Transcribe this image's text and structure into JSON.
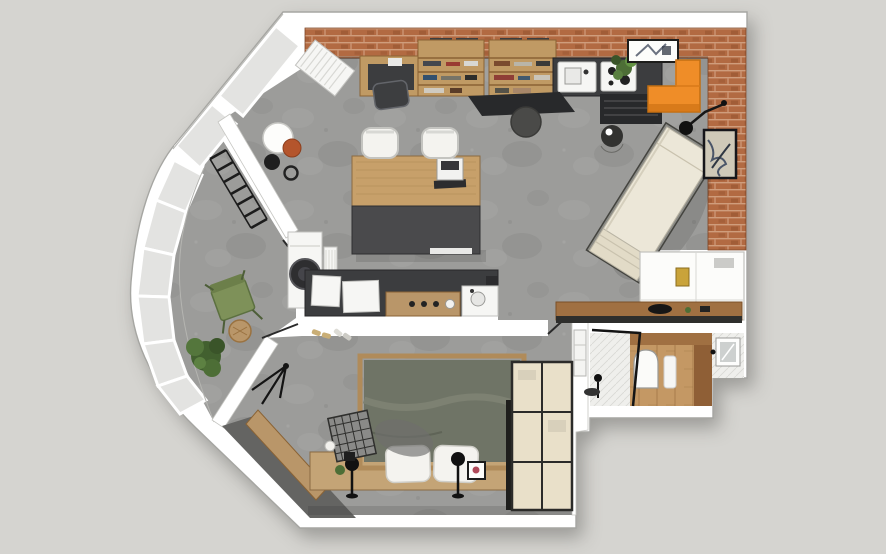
{
  "meta": {
    "title": "3D top-down floor plan render of a studio apartment with curved bay window, living-work studio, kitchen line, bedroom and bathroom",
    "view": "axonometric top view",
    "background_style": "light gray studio backdrop"
  },
  "palette": {
    "background": "#d5d4d0",
    "wall": "#ffffff",
    "wall_line": "#a6a6a2",
    "glass": "#e3e3e1",
    "brick": "#b26a42",
    "brick_dark": "#8c4d2b",
    "brick_mortar": "#cf9d7c",
    "floor": "#9c9c9a",
    "bay_floor": "#9a9a96",
    "wood": "#c7a06a",
    "wood_dark": "#8a6335",
    "shelf_wood": "#c09a64",
    "dark_unit": "#3c3d3f",
    "darker_unit": "#28292b",
    "black": "#1a1a1a",
    "orange": "#ef8d28",
    "orange_dark": "#cf7214",
    "cream": "#ece7d8",
    "cream_dark": "#e2dbc7",
    "blanket": "#6f7466",
    "blanket_fold": "#7d8172",
    "pillow": "#f4f3ef",
    "wardrobe": "#e9e0c9",
    "rug": "#646462",
    "bench_wood": "#b99669",
    "ledge_wood": "#c4a476",
    "green_chair": "#7e9159",
    "plant": "#4d6e36",
    "plant_dark": "#3a5429",
    "terracotta": "#b4552c",
    "bath_wood": "#a07042",
    "bath_wood_floor": "#c49864",
    "tile": "#efefec",
    "white_soft": "#f6f6f4",
    "gold": "#c9a33a"
  },
  "rooms": [
    {
      "id": "living-studio",
      "label": "living and work studio",
      "floor": "gray concrete",
      "walls": "exposed brick top and right"
    },
    {
      "id": "bay-lounge",
      "label": "curved bay-window lounge",
      "floor": "gray concrete",
      "walls": "curved glazing band"
    },
    {
      "id": "kitchen-line",
      "label": "kitchen line with counter and washing machine"
    },
    {
      "id": "bedroom",
      "label": "bedroom with double bed and wardrobe"
    },
    {
      "id": "hall-closet",
      "label": "hall niche with white built-in closet"
    },
    {
      "id": "bathroom",
      "label": "bathroom with shower, wood vanity zone and window"
    }
  ],
  "furniture": {
    "living_studio": [
      "wall desk with black chair",
      "two wooden bookshelf units with black boxes",
      "kitchen tall unit with sink and hob",
      "black fridge unit",
      "potted plant",
      "framed sketch on top wall",
      "orange corner sofa",
      "dark floor mat",
      "round dark pouf",
      "large work table (wood + dark half)",
      "laptop",
      "two white chairs",
      "round paper lamp, terracotta stool and black floor lamp",
      "white radiator panel",
      "cream fold-out daybed",
      "black wall lamp",
      "framed art on brick wall",
      "black round side table"
    ],
    "bay_lounge": [
      "black slatted radiator along partition",
      "green chair",
      "wooden stool",
      "leafy plant",
      "washing machine",
      "small white radiator"
    ],
    "kitchen_line": [
      "dark counter",
      "white cabinet boxes",
      "wood drawer unit with knobs",
      "sink block",
      "door leaf"
    ],
    "bedroom": [
      "double bed with gray-green blanket",
      "two white pillows",
      "wood headboard ledge",
      "two black bedside lamps",
      "small picture frame",
      "cream wardrobe with black frame",
      "dark gray floor rug",
      "diagonal wood bench",
      "wire basket chair",
      "black coat rack",
      "slippers",
      "window to light well"
    ],
    "hall_closet": [
      "white built-in closet",
      "gold mirror panel",
      "wood console with black bag"
    ],
    "bathroom": [
      "glass shower screen with black frame",
      "shower head",
      "arched mirror",
      "white towel",
      "wood vanity",
      "window with dark handle"
    ]
  }
}
